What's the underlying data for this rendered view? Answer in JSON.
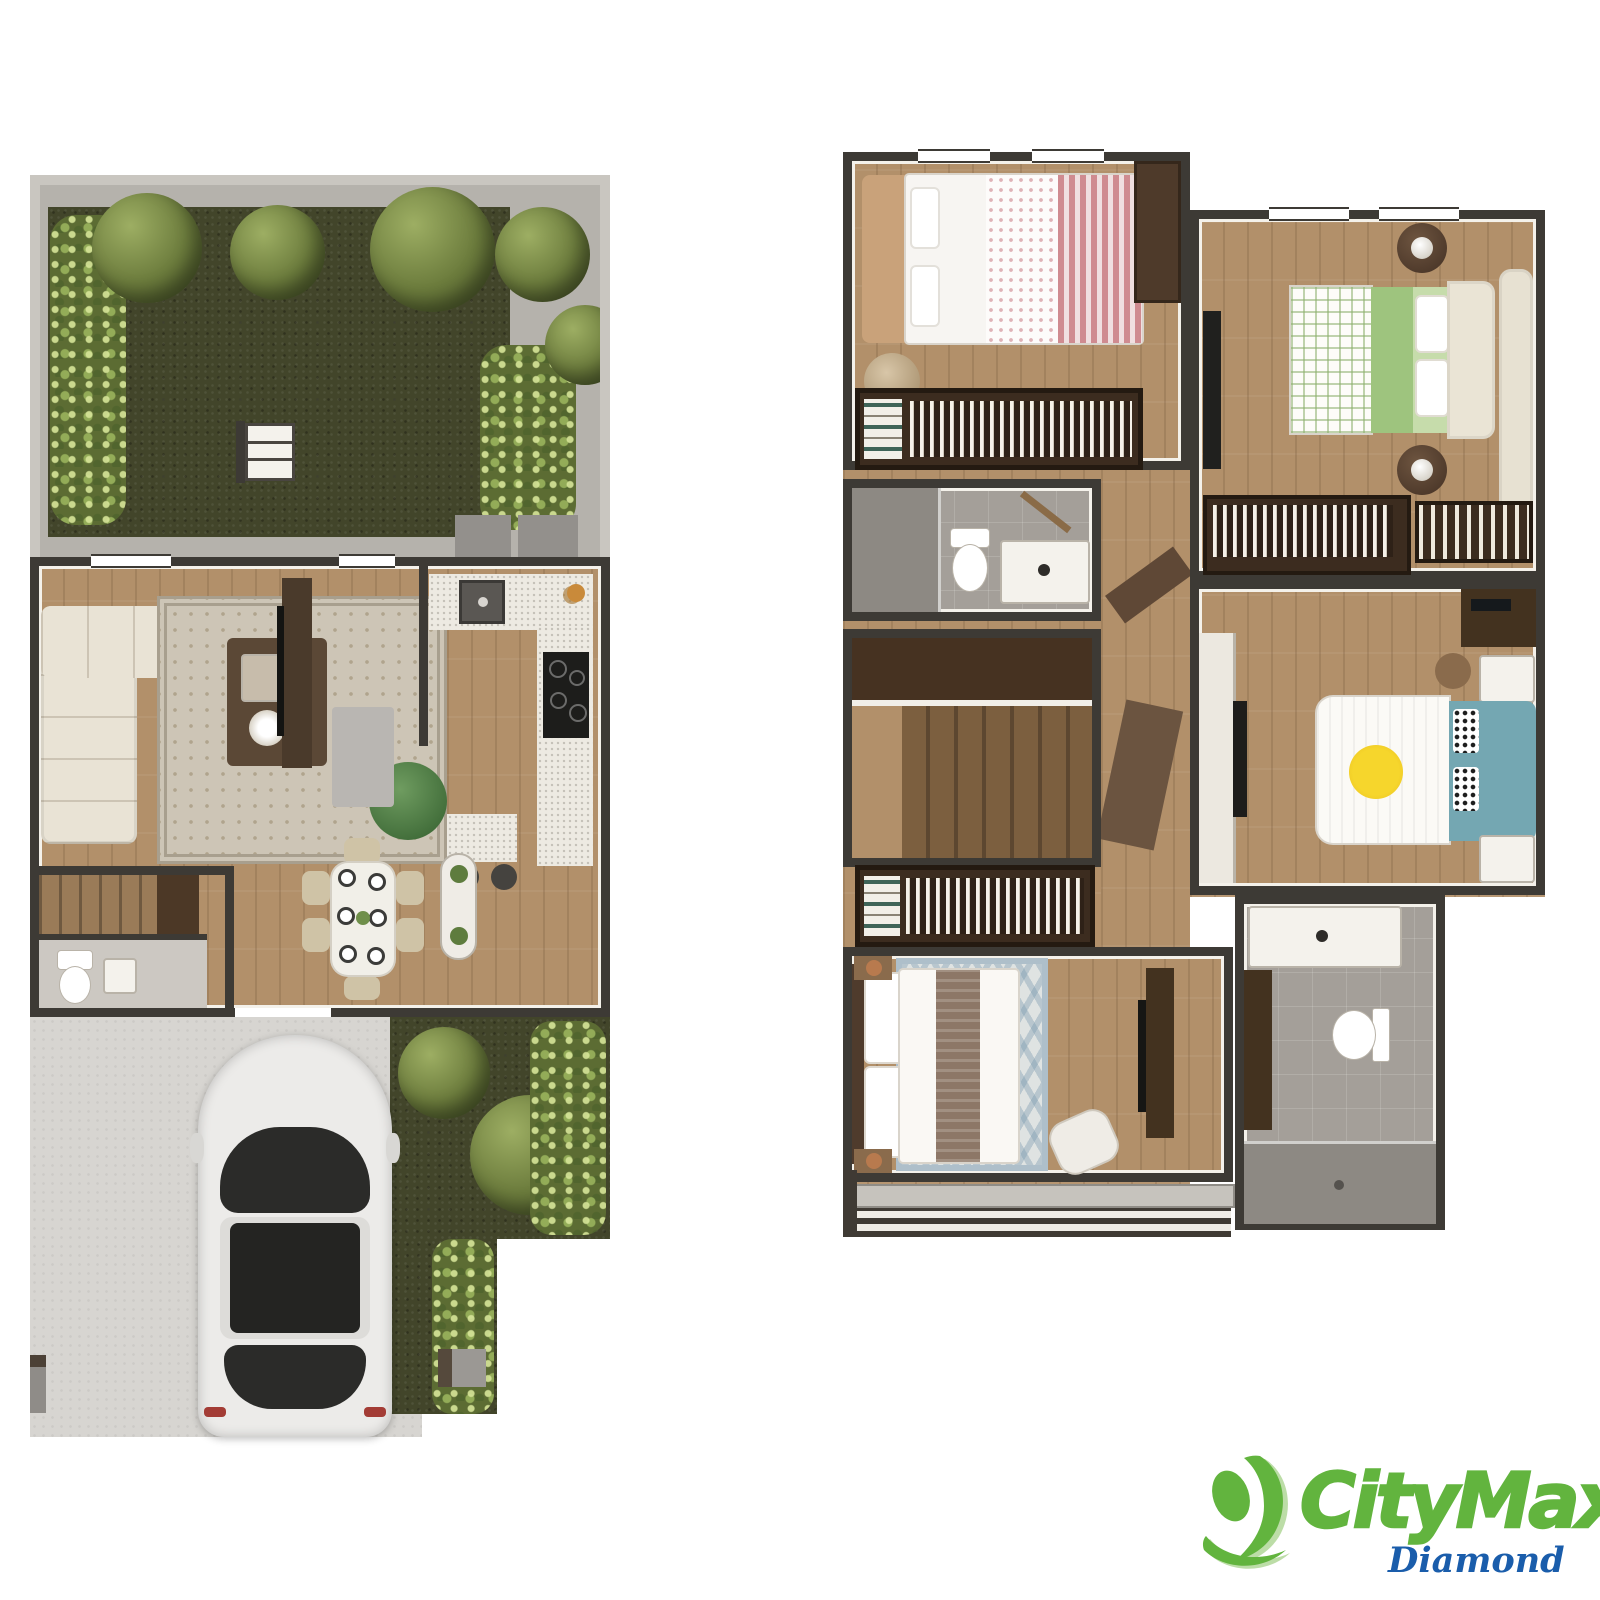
{
  "branding": {
    "logo_text": "CityMax",
    "registered_mark": "®",
    "sub_brand": "Diamond",
    "colors": {
      "green": "#62b43e",
      "green_light": "#a5d18a",
      "blue": "#1a5dab"
    }
  },
  "palette": {
    "background": "#ffffff",
    "wall_dark": "#3d3a35",
    "wall_gray": "#c9c6c0",
    "wall_lining": "#f4f1ea",
    "wood": "#b2906a",
    "wood_dark": "#9a7b58",
    "grass": "#42452a",
    "hedge": "#5c6c33",
    "tree": "#6b7b3c",
    "patio": "#b5b2ac",
    "driveway": "#d7d5d1",
    "tile": "#a49f99",
    "tile_dark": "#8d8983",
    "sofa": "#e9e3d5",
    "rug": "#cdc5b6",
    "table_wood": "#5b4836",
    "accent_chair": "#55824a",
    "counter": "#edeae2",
    "stove": "#1d1d1b",
    "closet": "#3c2c1f",
    "bed_pink": "#cf8b90",
    "bed_green": "#9ec47e",
    "bed_teal": "#74a7b2",
    "bed_brown": "#8d7767",
    "rug_blue": "#9db3c2",
    "car_body": "#ecebe9",
    "car_glass": "#2b2b29",
    "copper": "#b87a4e"
  },
  "plans": {
    "first_floor": {
      "rooms": [
        "garden",
        "patio",
        "living-room",
        "kitchen",
        "dining-room",
        "stairs",
        "half-bathroom",
        "driveway",
        "side-garden"
      ],
      "furniture": [
        "sectional-sofa",
        "area-rug",
        "coffee-table",
        "accent-chair",
        "ottoman",
        "tv-console",
        "kitchen-counter",
        "sink",
        "stove",
        "breakfast-bar",
        "bar-stools",
        "dining-table",
        "dining-chairs",
        "plant-console",
        "toilet",
        "hand-sink",
        "car",
        "garden-shelf",
        "ac-units",
        "hedges",
        "trees"
      ]
    },
    "second_floor": {
      "rooms": [
        "bedroom-1",
        "closet-1",
        "bathroom-1",
        "stairwell",
        "master-closet",
        "master-bedroom",
        "master-bathroom",
        "bedroom-2",
        "closet-2",
        "bedroom-3",
        "hallway",
        "balcony"
      ],
      "furniture": [
        "pink-bed",
        "pouf",
        "wardrobe",
        "hanging-clothes",
        "toilet",
        "shower",
        "vanity",
        "stairs",
        "master-bed",
        "hex-rug",
        "reading-chair",
        "tv-console",
        "green-plaid-bed",
        "round-nightstands",
        "chaise-bench",
        "sun-duvet-bed",
        "teal-headboard",
        "desk",
        "desk-chair",
        "nightstands",
        "balcony-louvers"
      ]
    }
  }
}
